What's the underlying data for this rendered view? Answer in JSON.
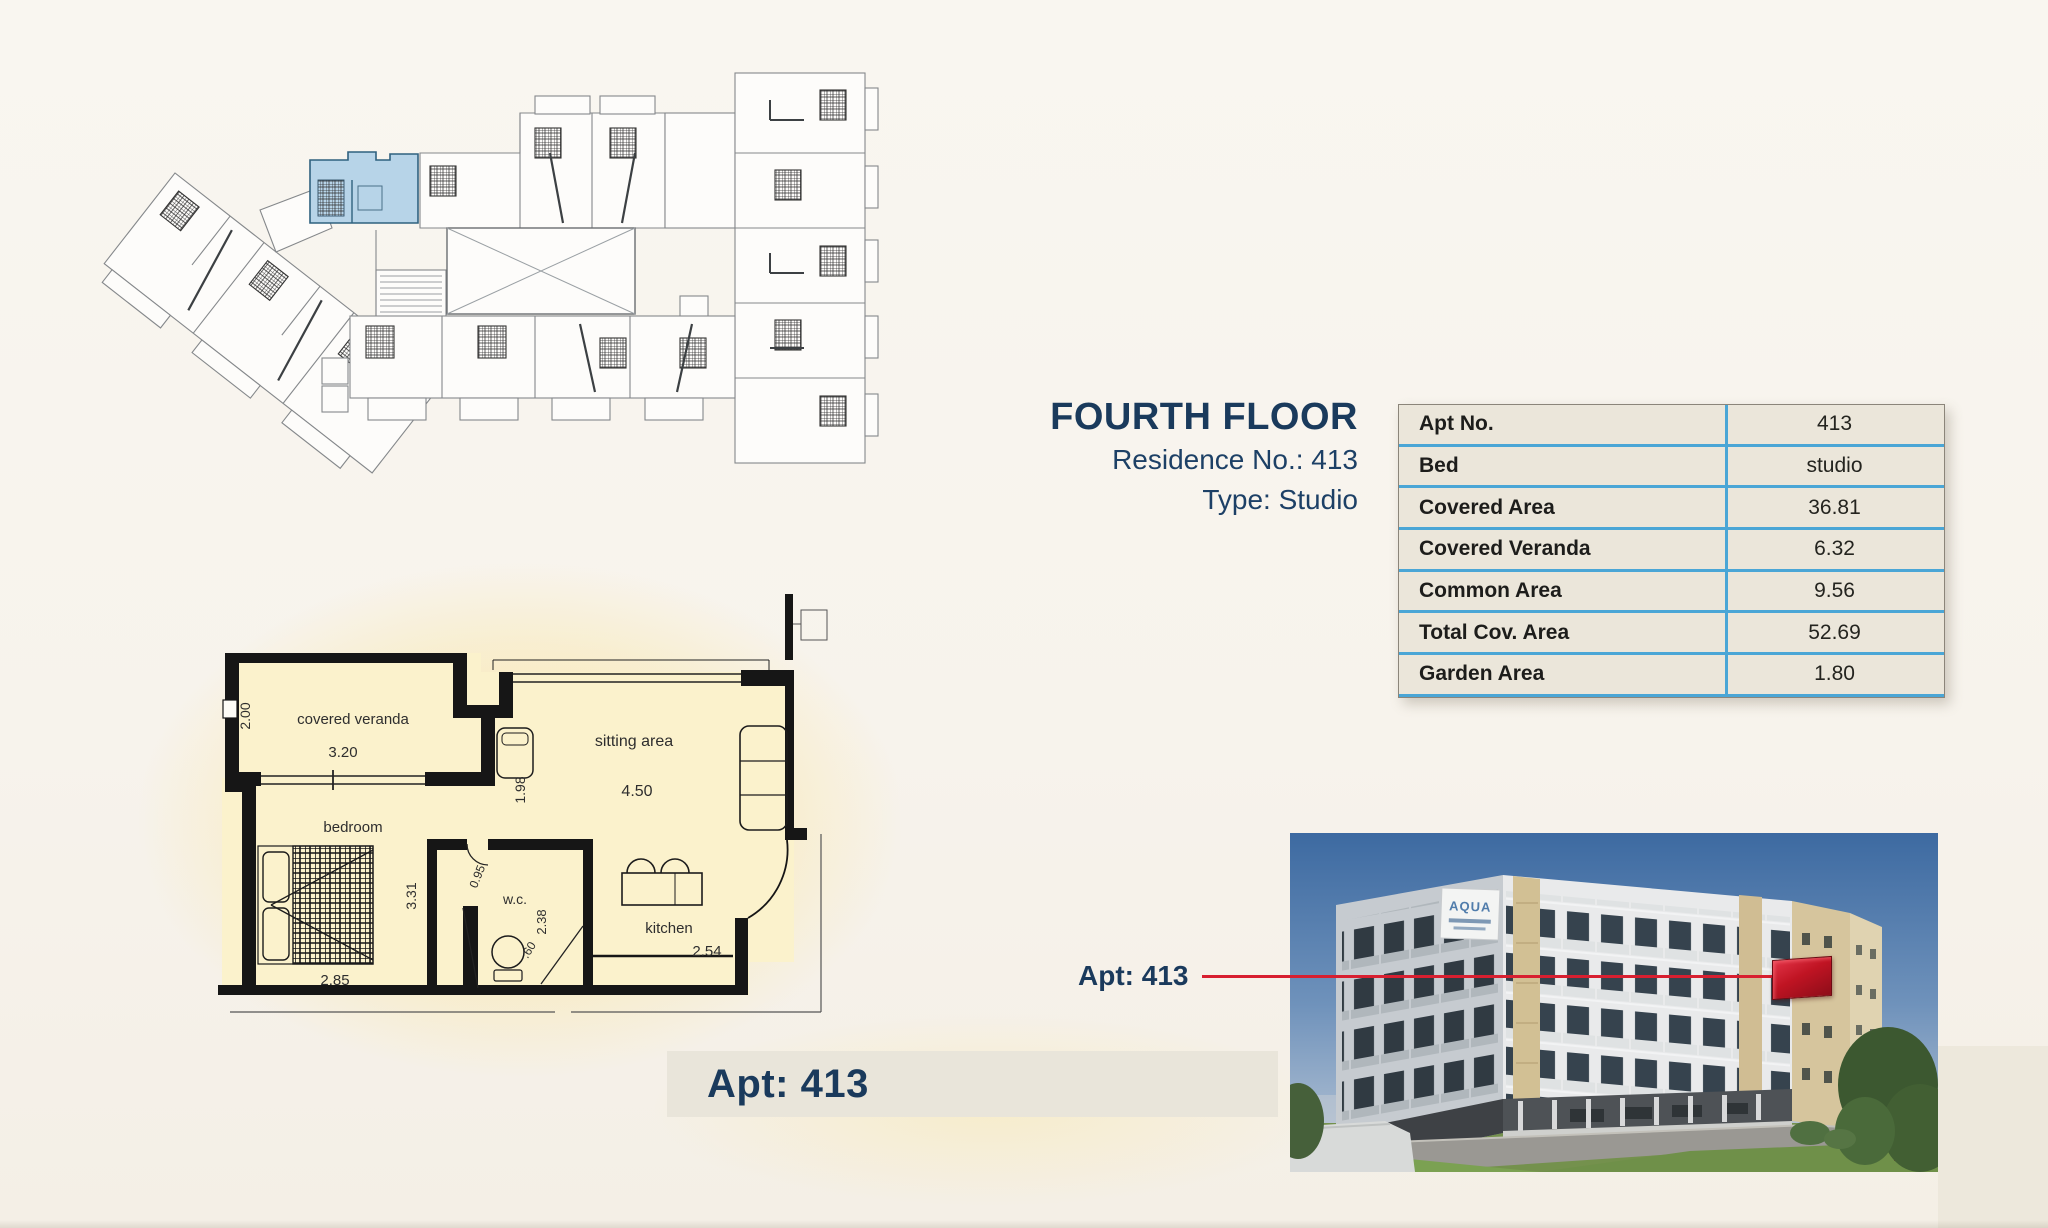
{
  "page": {
    "background": "#f8f5ef"
  },
  "header": {
    "title": "FOURTH FLOOR",
    "residence_line": "Residence No.: 413",
    "type_line": "Type: Studio"
  },
  "info_table": {
    "accent_color": "#4aa6d6",
    "rows": [
      {
        "label": "Apt No.",
        "value": "413"
      },
      {
        "label": "Bed",
        "value": "studio"
      },
      {
        "label": "Covered Area",
        "value": "36.81"
      },
      {
        "label": "Covered Veranda",
        "value": "6.32"
      },
      {
        "label": "Common Area",
        "value": "9.56"
      },
      {
        "label": "Total Cov. Area",
        "value": "52.69"
      },
      {
        "label": "Garden Area",
        "value": "1.80"
      }
    ]
  },
  "detail_plan": {
    "veranda_label": "covered veranda",
    "veranda_width": "3.20",
    "veranda_depth": "2.00",
    "sitting_label": "sitting area",
    "sitting_width": "4.50",
    "sitting_depth": "1.98",
    "bedroom_label": "bedroom",
    "bedroom_width": "2.85",
    "bedroom_depth": "3.31",
    "wc_label": "w.c.",
    "wc_door": "0.95",
    "wc_depth": "2.38",
    "wc_width": ".60",
    "kitchen_label": "kitchen",
    "kitchen_width": "2.54"
  },
  "apt_banner": {
    "label": "Apt: 413"
  },
  "building_photo": {
    "callout_label": "Apt: 413",
    "callout_color": "#d81f30",
    "highlight_color": "#c01423",
    "sign_text": "AQUA"
  },
  "overview_plan": {
    "highlight_color": "#b7d4e8"
  }
}
